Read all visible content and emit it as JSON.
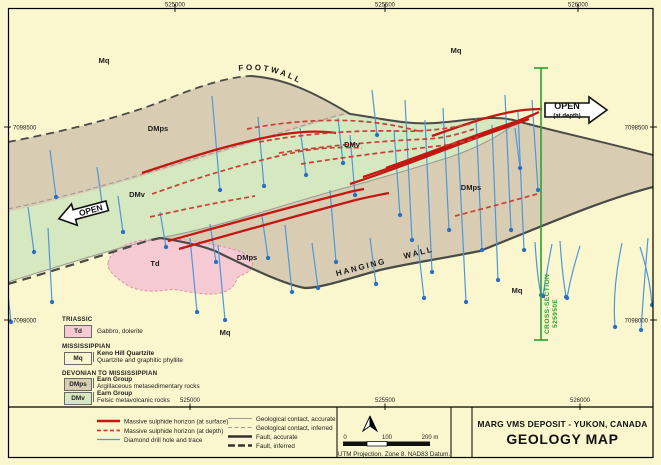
{
  "map": {
    "eastings_top": [
      "525000",
      "525500",
      "526000"
    ],
    "eastings_bottom": [
      "525000",
      "525500",
      "526000"
    ],
    "northings_left": [
      "7098500",
      "7098000"
    ],
    "northings_right": [
      "7098500",
      "7098000"
    ],
    "labels": [
      "Mq",
      "Mq",
      "DMps",
      "DMv",
      "DMps",
      "DMv",
      "Td",
      "DMps",
      "Mq",
      "Mq"
    ],
    "footwall": "FOOTWALL",
    "hanging_wall": "HANGING WALL",
    "open_left": "OPEN",
    "open_right": "OPEN",
    "open_right_sub": "(at depth)",
    "cross_section": "CROSS-SECTION",
    "cross_section_sub": "525950E"
  },
  "unit_legend": {
    "triassic": "TRIASSIC",
    "td_code": "Td",
    "td_name": "Gabbro, dolerite",
    "mississippian": "MISSISSIPPIAN",
    "mq_code": "Mq",
    "mq_name": "Keno Hill Quartzite",
    "mq_desc": "Quartzite and graphitic phyllite",
    "devonian": "DEVONIAN TO MISSISSIPPIAN",
    "dmps_code": "DMps",
    "dmps_name": "Earn Group",
    "dmps_desc": "Argillaceous metasedimentary rocks",
    "dmv_code": "DMv",
    "dmv_name": "Earn Group",
    "dmv_desc": "Felsic metavolcanic rocks"
  },
  "line_legend": {
    "col1": [
      "Massive sulphide horizon (at surface)",
      "Massive sulphide horizon (at depth)",
      "Diamond drill hole and trace"
    ],
    "col2": [
      "Geological contact, accurate",
      "Geological contact, inferred",
      "Fault, accurate",
      "Fault, inferred"
    ]
  },
  "scale": {
    "t0": "0",
    "t100": "100",
    "t200": "200 m",
    "note": "UTM Projection. Zone 8. NAD83 Datum."
  },
  "title_block": {
    "line1": "MARG VMS DEPOSIT - YUKON, CANADA",
    "line2": "GEOLOGY MAP"
  },
  "colors": {
    "background": "#FAF6CD",
    "mq": "#FAF6CD",
    "dmps": "#D8CCB2",
    "dmv": "#D5E8C0",
    "td": "#F6CAD3",
    "sulphide_red": "#C41712",
    "drill_blue": "#4E97D9",
    "fault_dark": "#4A4A46",
    "contact_gray": "#9C9C94",
    "cross_section_green": "#2E9F33"
  }
}
